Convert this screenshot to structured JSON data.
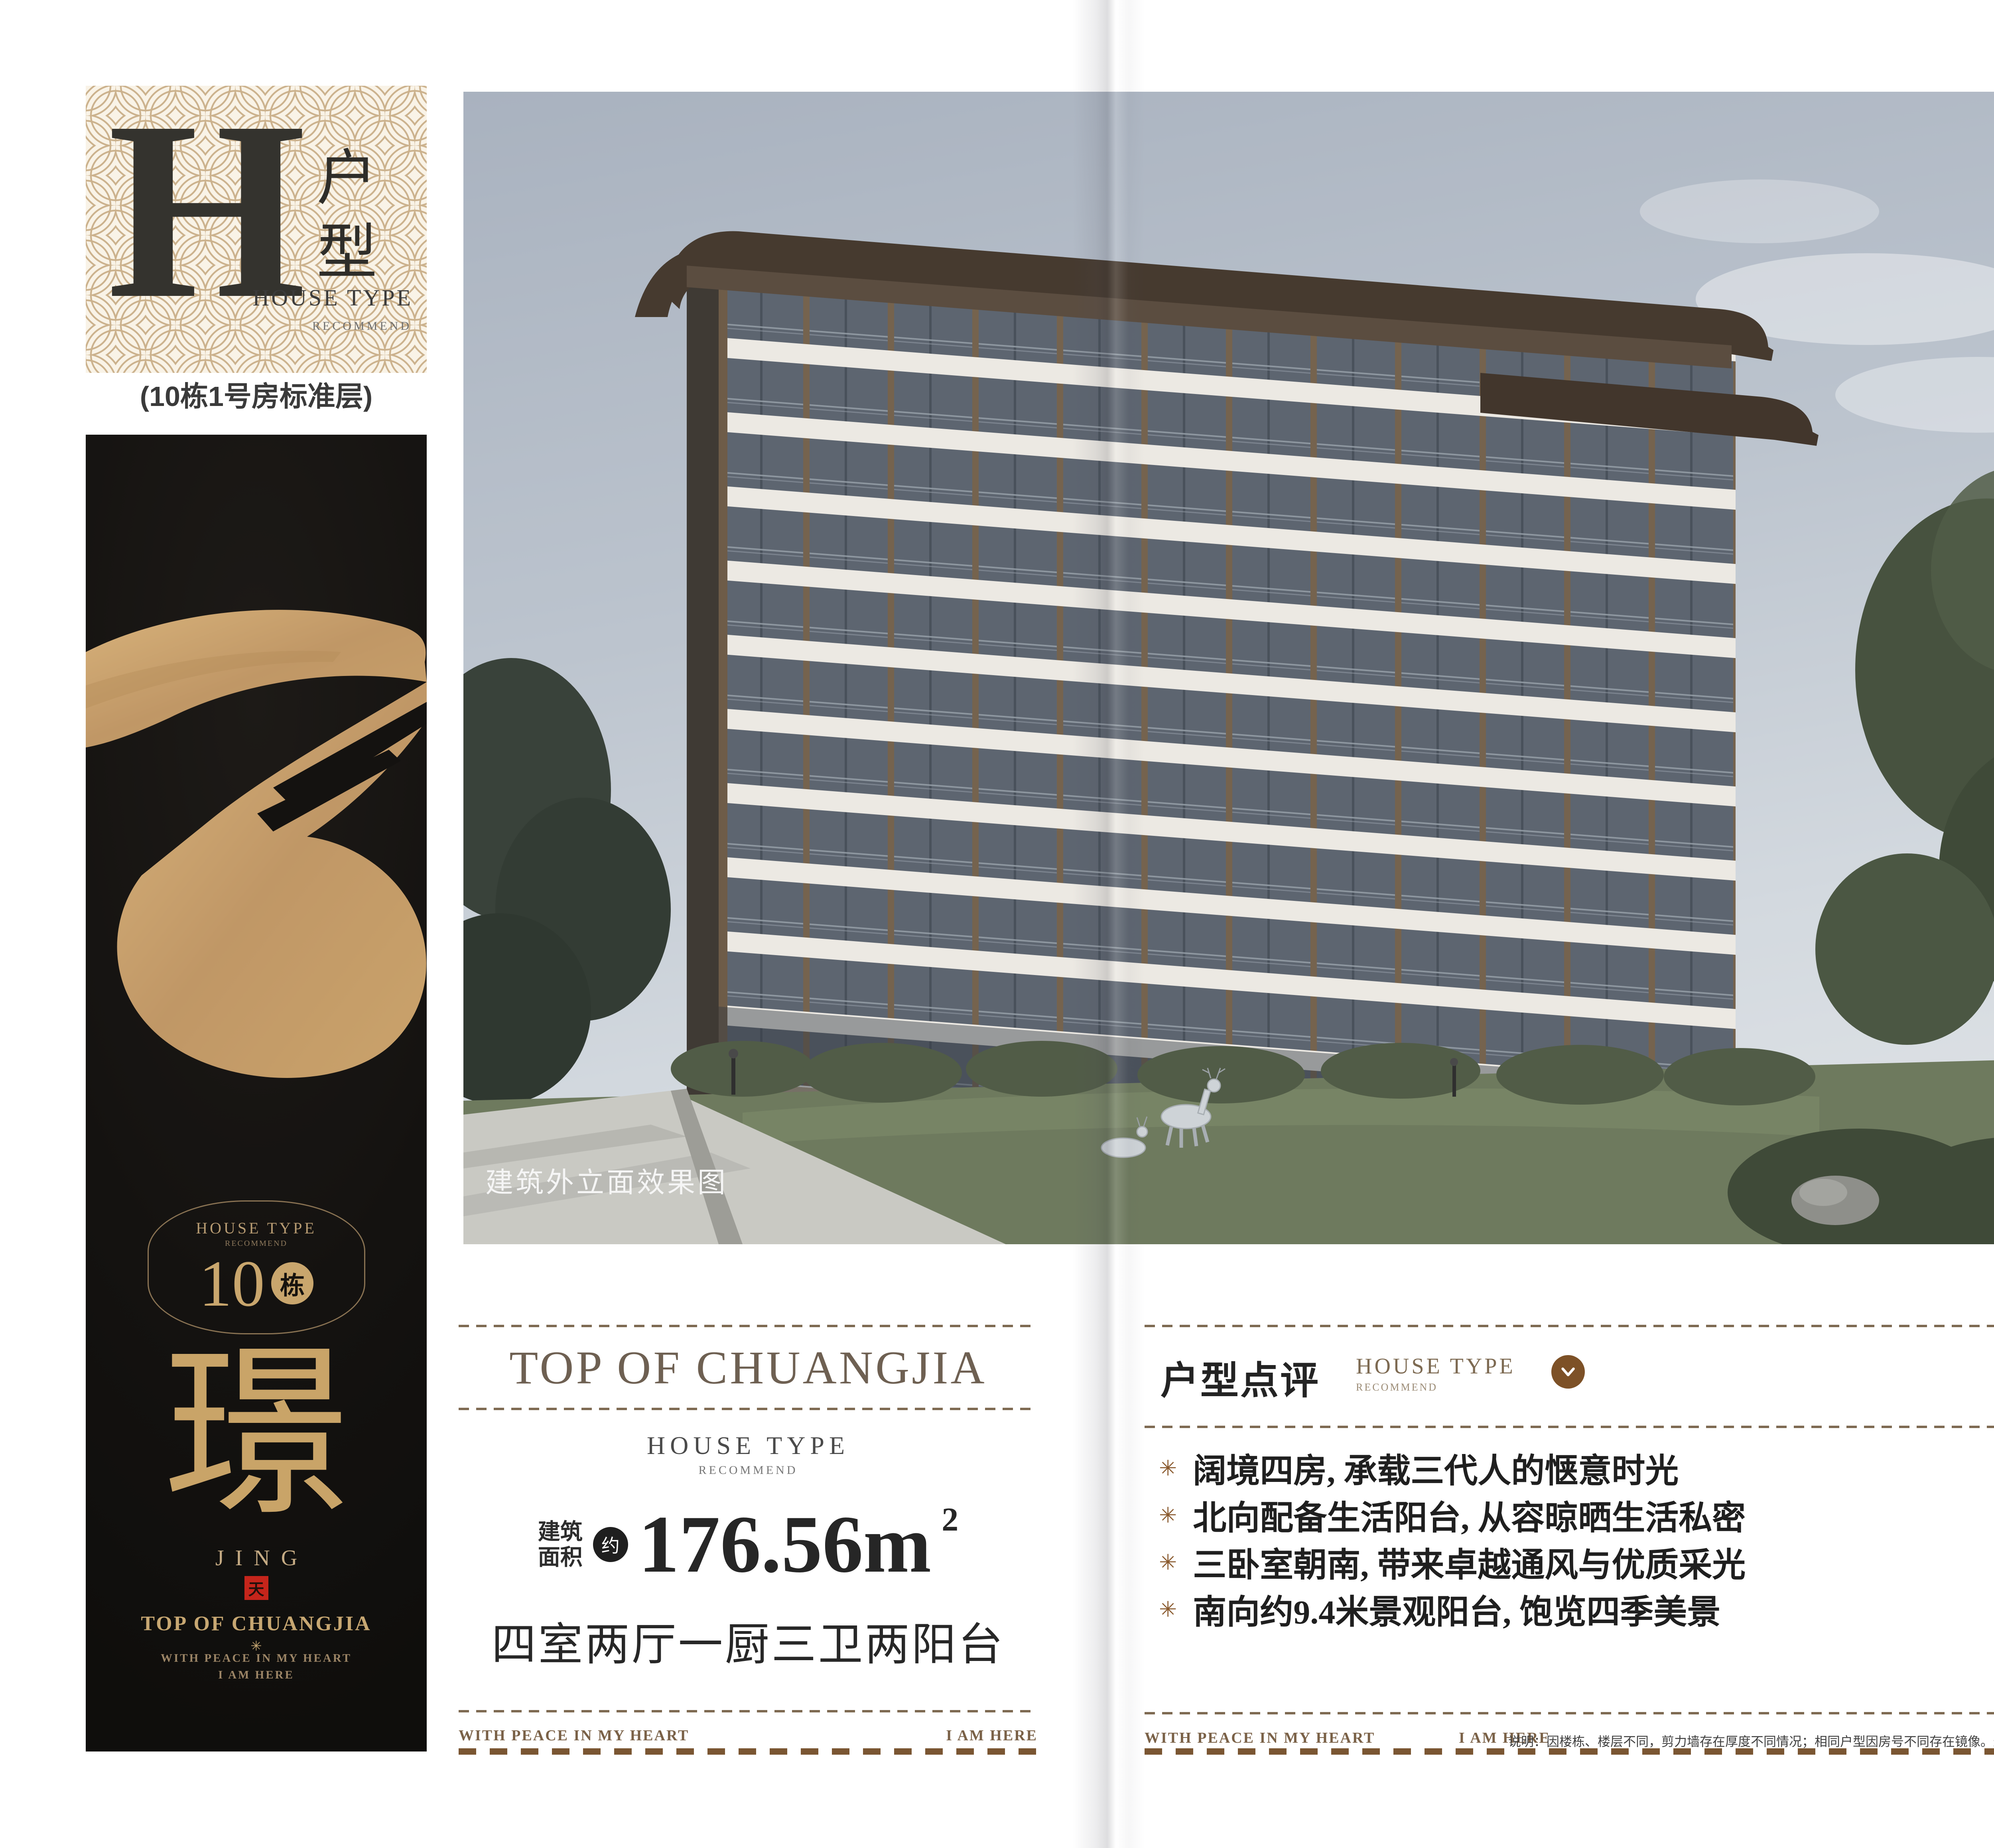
{
  "tab": {
    "letter": "H",
    "vertical": "户型",
    "house_type": "HOUSE TYPE",
    "recommend": "RECOMMEND",
    "subtitle": "(10栋1号房标准层)"
  },
  "banner": {
    "emblem_top": "HOUSE TYPE",
    "emblem_sub": "RECOMMEND",
    "number": "10",
    "unit": "栋",
    "glyph": "璟",
    "pinyin": "JING",
    "seal": "天",
    "brand": "TOP OF CHUANGJIA",
    "star": "✳",
    "line1": "WITH PEACE IN MY HEART",
    "line2": "I AM HERE"
  },
  "photo": {
    "caption": "建筑外立面效果图"
  },
  "summary": {
    "title": "TOP OF CHUANGJIA",
    "house_type": "HOUSE TYPE",
    "recommend": "RECOMMEND",
    "area_prefix_1": "建筑",
    "area_prefix_2": "面积",
    "approx": "约",
    "value": "176.56m",
    "sup": "2",
    "rooms": "四室两厅一厨三卫两阳台",
    "foot_left": "WITH PEACE IN MY HEART",
    "foot_right": "I AM HERE"
  },
  "review": {
    "title": "户型点评",
    "subtitle": "HOUSE TYPE",
    "subtitle_sub": "RECOMMEND",
    "bullet_icon": "✳",
    "bullets": [
      "阔境四房, 承载三代人的惬意时光",
      "北向配备生活阳台, 从容晾晒生活私密",
      "三卧室朝南, 带来卓越通风与优质采光",
      "南向约9.4米景观阳台, 饱览四季美景"
    ],
    "foot_left": "WITH PEACE IN MY HEART",
    "foot_right": "I AM HERE",
    "note": "说明：因楼栋、楼层不同，剪力墙存在厚度不同情况；相同户型因房号不同存在镜像。最终请以实际交付为准。"
  },
  "plan": {
    "logo_top": "TOP OF",
    "logo_star": "*",
    "logo_bottom": "CHUANGJIA",
    "tagline": [
      "THE ULTIMATE",
      "REAL ESTATE PROJECT",
      "REPRESENTING",
      "TRANQUILITY"
    ],
    "header_cn": "户型平面图",
    "header_en": "Unit Plan",
    "legend": "半计入产权面积",
    "rooms": {
      "balcony_top": "阳台",
      "kitchen": "厨房",
      "dining": "餐厅",
      "bath_a": "卫生间",
      "bed_a": "卧室",
      "bath_b": "卫生间",
      "bath_c": "卫生间",
      "bed_b": "卧室",
      "living": "客厅",
      "bed_c": "卧室",
      "master": "主卧",
      "balcony_bottom": "阳台"
    },
    "dims_bottom": [
      "约3500",
      "约6100",
      "约3300",
      "约3900"
    ],
    "dims_right": [
      "约1400",
      "约3300",
      "约5300",
      "约1900"
    ],
    "structure_cn": "户型结构",
    "structure_en": "House type structure",
    "placement_cn": "户型落位",
    "placement_en": "House type placement",
    "site": {
      "b3": {
        "name": "3幢",
        "units": [
          "1",
          "2",
          "3",
          "4"
        ]
      },
      "b5": {
        "name": "5幢",
        "units": [
          "1",
          "2"
        ]
      },
      "b2": {
        "name": "2幢",
        "units": [
          "2",
          "1"
        ]
      },
      "b11": {
        "name": "11幢",
        "units": [
          "2",
          "1"
        ]
      },
      "b10": {
        "name": "10幢",
        "units": [
          "4",
          "3",
          "2",
          "1"
        ]
      }
    },
    "disclaimer": "本广告文字图片仅作要约邀请，不作为双方签署《商品房买卖合同》及补充协议的内容，实际以双方签署的《商品房买卖合同》及补充协议为准。开发商：创佳地产。设计时间：2025年5月20日；有效时间：2025年12月30日"
  },
  "colors": {
    "accent_brown": "#7d5127",
    "gold": "#c9a468",
    "dark_bg": "#161412",
    "seal_red": "#c5251b",
    "badge_red": "#d6281e",
    "site_green": "#dcead0",
    "highlight_unit": "#b5885e",
    "balcony_dash_yellow": "#f2ce1c"
  }
}
